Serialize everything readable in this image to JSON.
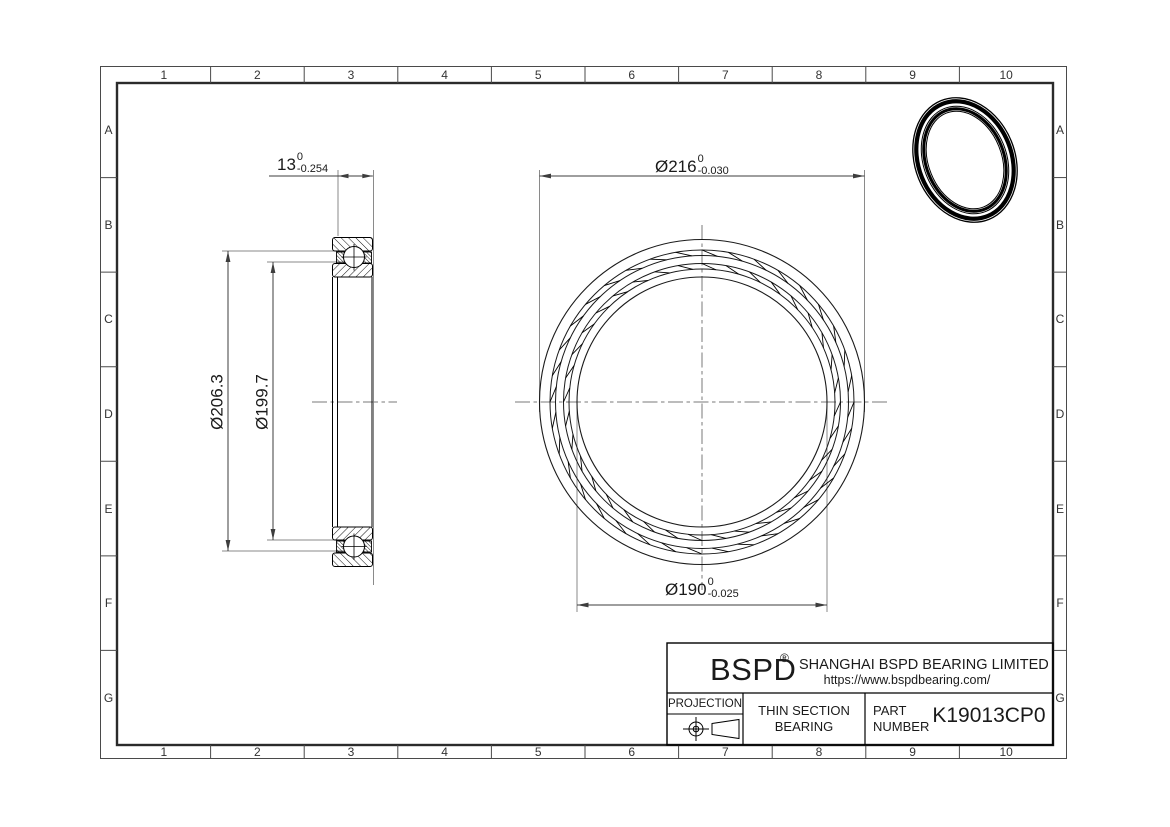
{
  "grid": {
    "columns": [
      "1",
      "2",
      "3",
      "4",
      "5",
      "6",
      "7",
      "8",
      "9",
      "10"
    ],
    "rows": [
      "A",
      "B",
      "C",
      "D",
      "E",
      "F",
      "G"
    ]
  },
  "dimensions": {
    "width": {
      "value": "13",
      "tol_upper": "0",
      "tol_lower": "-0.254"
    },
    "outer_diameter": {
      "value": "Ø216",
      "tol_upper": "0",
      "tol_lower": "-0.030"
    },
    "bore_diameter": {
      "value": "Ø190",
      "tol_upper": "0",
      "tol_lower": "-0.025"
    },
    "outer_race_diameter": {
      "value": "Ø206.3"
    },
    "inner_race_diameter": {
      "value": "Ø199.7"
    }
  },
  "title_block": {
    "logo": "BSPD",
    "registered": "®",
    "company": "SHANGHAI BSPD BEARING LIMITED",
    "website": "https://www.bspdbearing.com/",
    "projection_label": "PROJECTION",
    "product_line1": "THIN SECTION",
    "product_line2": "BEARING",
    "part_label_line1": "PART",
    "part_label_line2": "NUMBER",
    "part_number": "K19013CP0"
  },
  "colors": {
    "line": "#000000",
    "dimension": "#3d3d3d",
    "extension": "#8a8a8a",
    "background": "#ffffff"
  }
}
